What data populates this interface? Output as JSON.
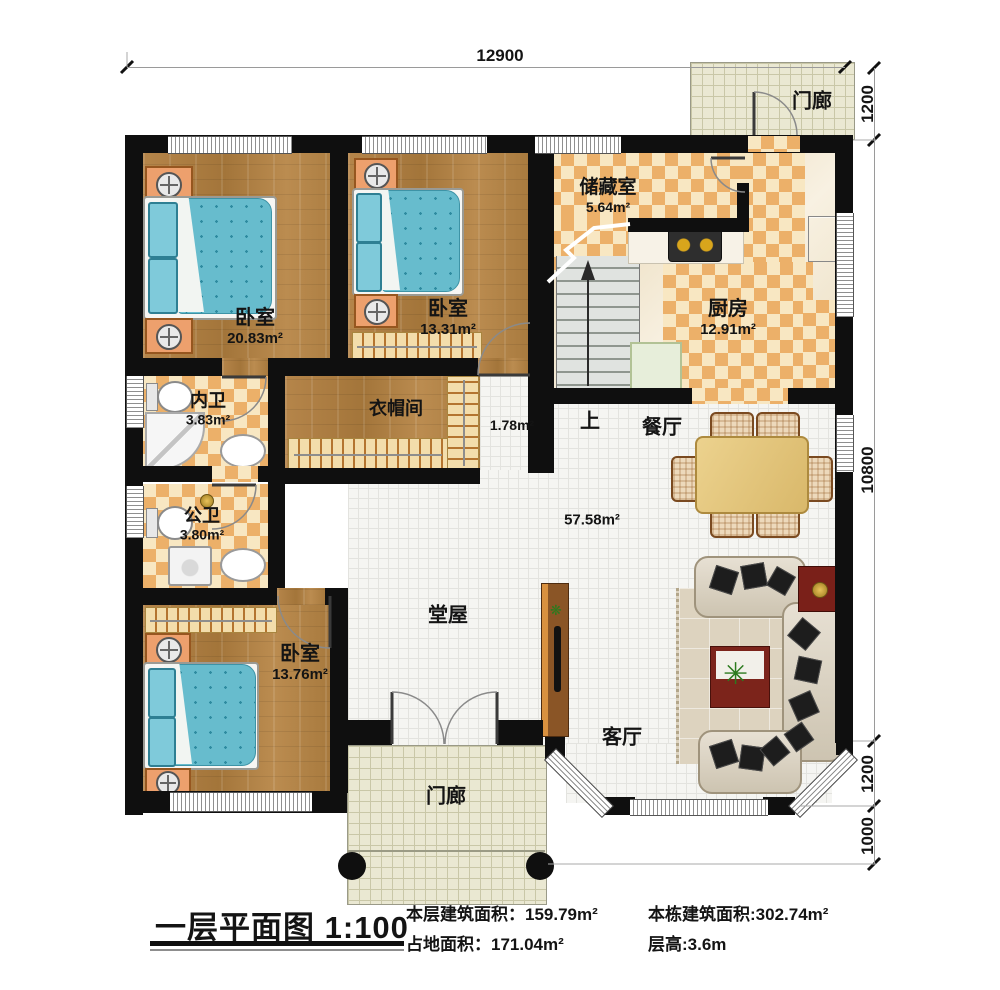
{
  "title_block": {
    "title": "一层平面图",
    "scale": "1:100",
    "stats": [
      {
        "label": "本层建筑面积：",
        "value": "159.79m²"
      },
      {
        "label": "占地面积：",
        "value": "171.04m²"
      },
      {
        "label": "本栋建筑面积:",
        "value": "302.74m²"
      },
      {
        "label": "层高:",
        "value": "3.6m"
      }
    ]
  },
  "rooms": {
    "bedroom_top_left": {
      "name": "卧室",
      "area": "20.83m²"
    },
    "bedroom_top_mid": {
      "name": "卧室",
      "area": "13.31m²"
    },
    "bedroom_bottom_left": {
      "name": "卧室",
      "area": "13.76m²"
    },
    "storage": {
      "name": "储藏室",
      "area": "5.64m²"
    },
    "kitchen": {
      "name": "厨房",
      "area": "12.91m²"
    },
    "bath_ensuite": {
      "name": "内卫",
      "area": "3.83m²"
    },
    "bath_public": {
      "name": "公卫",
      "area": "3.80m²"
    },
    "cloakroom": {
      "name": "衣帽间"
    },
    "hallway": {
      "area": "1.78m²"
    },
    "dining": {
      "name": "餐厅"
    },
    "main_hall": {
      "name": "堂屋",
      "area": "57.58m²"
    },
    "living": {
      "name": "客厅"
    },
    "porch_top": {
      "name": "门廊"
    },
    "porch_bottom": {
      "name": "门廊"
    },
    "stairs": {
      "up_label": "上"
    }
  },
  "dimensions": {
    "top": "12900",
    "right_top": "1200",
    "right_main": "10800",
    "right_bay": "1200",
    "right_porch": "1000"
  },
  "colors": {
    "wall": "#0f0f0f",
    "wood_floor": "#ad7b3e",
    "tile_accent": "#ecb069",
    "bed_blue": "#67bccd",
    "table_red": "#7c241b"
  }
}
